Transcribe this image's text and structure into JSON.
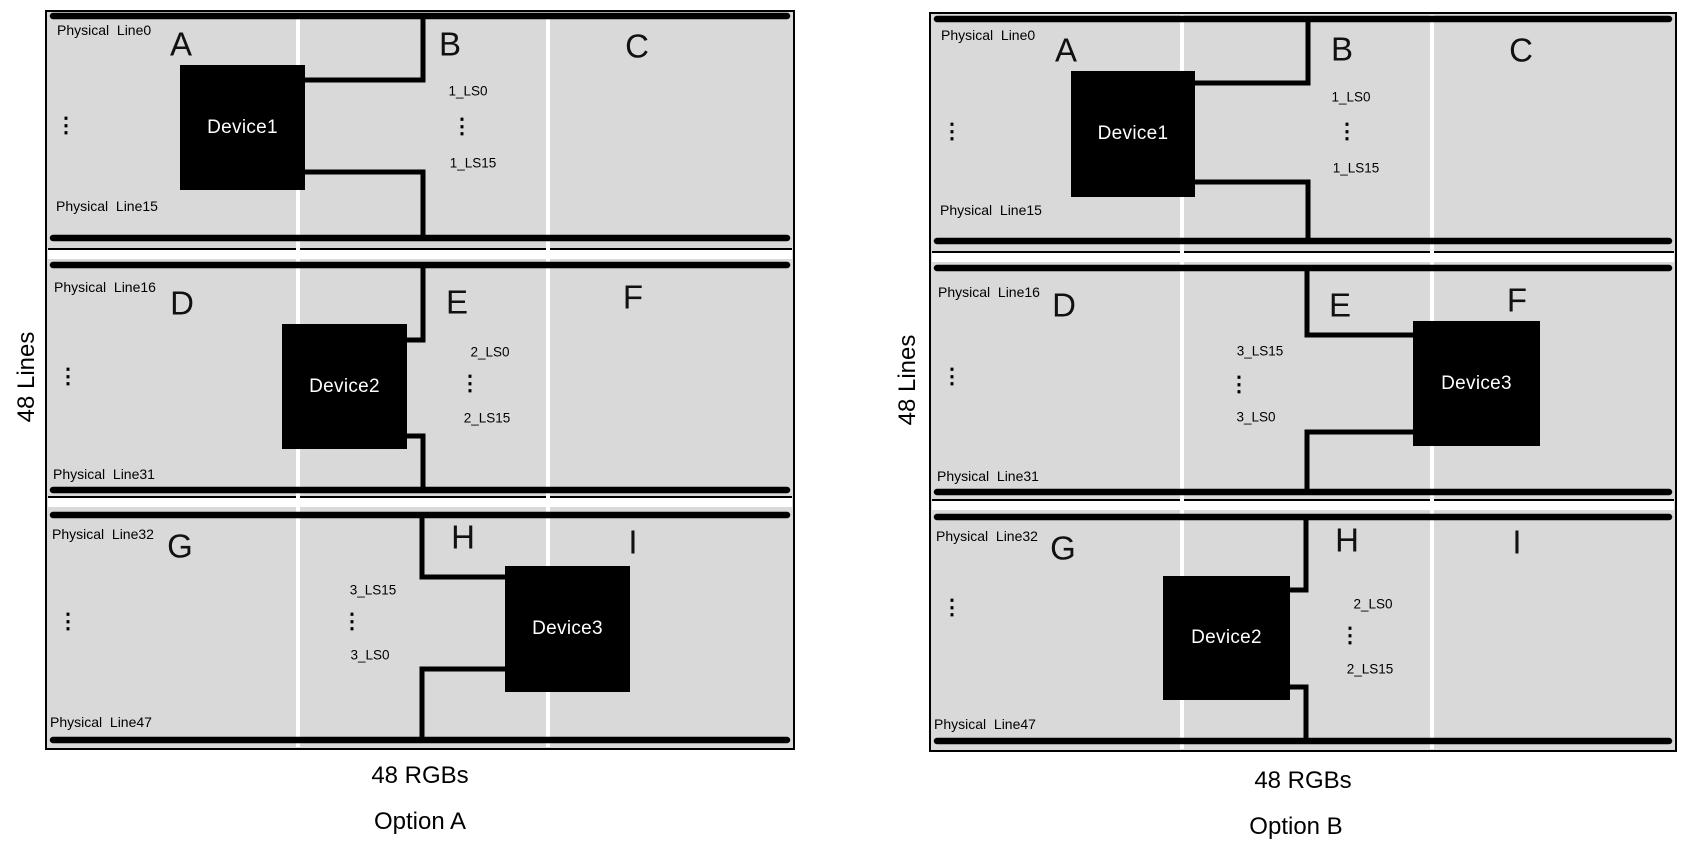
{
  "colors": {
    "background": "#ffffff",
    "panel_fill": "#d9d9d9",
    "bus_line": "#000000",
    "wire": "#000000",
    "device_fill": "#000000",
    "device_text": "#ffffff",
    "cell_divider": "#ffffff"
  },
  "options": [
    {
      "id": "a",
      "caption": "Option A",
      "lines_axis_label": "48 Lines",
      "rgbs_axis_label": "48 RGBs",
      "panel": {
        "x": 45,
        "y": 10,
        "w": 750,
        "h": 740
      },
      "dividers_x": [
        296,
        546
      ],
      "band_gaps": [
        {
          "line_y": 248,
          "strip_y": 250,
          "strip_h": 9
        },
        {
          "line_y": 496,
          "strip_y": 498,
          "strip_h": 9
        }
      ],
      "bus_lines": [
        {
          "name": "physical-line0-bus",
          "y": 16,
          "label": "Physical  Line0",
          "label_x": 57,
          "label_y": 22
        },
        {
          "name": "physical-line15-bus",
          "y": 238,
          "label": "Physical  Line15",
          "label_x": 56,
          "label_y": 198
        },
        {
          "name": "physical-line16-bus",
          "y": 265,
          "label": "Physical  Line16",
          "label_x": 54,
          "label_y": 279
        },
        {
          "name": "physical-line31-bus",
          "y": 490,
          "label": "Physical  Line31",
          "label_x": 53,
          "label_y": 466
        },
        {
          "name": "physical-line32-bus",
          "y": 515,
          "label": "Physical  Line32",
          "label_x": 52,
          "label_y": 526
        },
        {
          "name": "physical-line47-bus",
          "y": 740,
          "label": "Physical  Line47",
          "label_x": 50,
          "label_y": 714
        }
      ],
      "region_letters": [
        {
          "t": "A",
          "x": 181,
          "y": 44
        },
        {
          "t": "B",
          "x": 450,
          "y": 44
        },
        {
          "t": "C",
          "x": 637,
          "y": 46
        },
        {
          "t": "D",
          "x": 182,
          "y": 303
        },
        {
          "t": "E",
          "x": 457,
          "y": 302
        },
        {
          "t": "F",
          "x": 633,
          "y": 297
        },
        {
          "t": "G",
          "x": 180,
          "y": 546
        },
        {
          "t": "H",
          "x": 463,
          "y": 537
        },
        {
          "t": "I",
          "x": 633,
          "y": 542
        }
      ],
      "devices": [
        {
          "label": "Device1",
          "x": 180,
          "y": 65,
          "w": 125,
          "h": 125
        },
        {
          "label": "Device2",
          "x": 282,
          "y": 324,
          "w": 125,
          "h": 125
        },
        {
          "label": "Device3",
          "x": 505,
          "y": 566,
          "w": 125,
          "h": 126
        }
      ],
      "ls_labels": [
        {
          "t": "1_LS0",
          "x": 468,
          "y": 91
        },
        {
          "t": "1_LS15",
          "x": 473,
          "y": 163
        },
        {
          "t": "2_LS0",
          "x": 490,
          "y": 352
        },
        {
          "t": "2_LS15",
          "x": 487,
          "y": 418
        },
        {
          "t": "3_LS15",
          "x": 373,
          "y": 590
        },
        {
          "t": "3_LS0",
          "x": 370,
          "y": 655
        }
      ],
      "ellipses": [
        {
          "x": 66,
          "y": 126
        },
        {
          "x": 462,
          "y": 127
        },
        {
          "x": 68,
          "y": 377
        },
        {
          "x": 470,
          "y": 384
        },
        {
          "x": 68,
          "y": 622
        },
        {
          "x": 352,
          "y": 622
        }
      ],
      "wires": [
        {
          "name": "device1-top-wire",
          "points": "303,80 423,80 423,16"
        },
        {
          "name": "device1-bottom-wire",
          "points": "303,172 423,172 423,238"
        },
        {
          "name": "device2-top-wire",
          "points": "406,340 423,340 423,265"
        },
        {
          "name": "device2-bottom-wire",
          "points": "406,436 423,436 423,490"
        },
        {
          "name": "device3-top-wire",
          "points": "506,577 422,577 422,515"
        },
        {
          "name": "device3-bottom-wire",
          "points": "506,669 422,669 422,740"
        }
      ]
    },
    {
      "id": "b",
      "caption": "Option B",
      "lines_axis_label": "48 Lines",
      "rgbs_axis_label": "48 RGBs",
      "panel": {
        "x": 929,
        "y": 12,
        "w": 748,
        "h": 740
      },
      "dividers_x": [
        1180,
        1430
      ],
      "band_gaps": [
        {
          "line_y": 251,
          "strip_y": 253,
          "strip_h": 9
        },
        {
          "line_y": 499,
          "strip_y": 501,
          "strip_h": 9
        }
      ],
      "bus_lines": [
        {
          "name": "physical-line0-bus",
          "y": 19,
          "label": "Physical  Line0",
          "label_x": 941,
          "label_y": 27
        },
        {
          "name": "physical-line15-bus",
          "y": 241,
          "label": "Physical  Line15",
          "label_x": 940,
          "label_y": 202
        },
        {
          "name": "physical-line16-bus",
          "y": 268,
          "label": "Physical  Line16",
          "label_x": 938,
          "label_y": 284
        },
        {
          "name": "physical-line31-bus",
          "y": 492,
          "label": "Physical  Line31",
          "label_x": 937,
          "label_y": 468
        },
        {
          "name": "physical-line32-bus",
          "y": 517,
          "label": "Physical  Line32",
          "label_x": 936,
          "label_y": 528
        },
        {
          "name": "physical-line47-bus",
          "y": 741,
          "label": "Physical  Line47",
          "label_x": 934,
          "label_y": 716
        }
      ],
      "region_letters": [
        {
          "t": "A",
          "x": 1066,
          "y": 50
        },
        {
          "t": "B",
          "x": 1342,
          "y": 49
        },
        {
          "t": "C",
          "x": 1521,
          "y": 50
        },
        {
          "t": "D",
          "x": 1064,
          "y": 305
        },
        {
          "t": "E",
          "x": 1340,
          "y": 305
        },
        {
          "t": "F",
          "x": 1517,
          "y": 300
        },
        {
          "t": "G",
          "x": 1063,
          "y": 548
        },
        {
          "t": "H",
          "x": 1347,
          "y": 540
        },
        {
          "t": "I",
          "x": 1517,
          "y": 542
        }
      ],
      "devices": [
        {
          "label": "Device1",
          "x": 1071,
          "y": 71,
          "w": 124,
          "h": 126
        },
        {
          "label": "Device3",
          "x": 1413,
          "y": 321,
          "w": 127,
          "h": 125
        },
        {
          "label": "Device2",
          "x": 1163,
          "y": 576,
          "w": 127,
          "h": 124
        }
      ],
      "ls_labels": [
        {
          "t": "1_LS0",
          "x": 1351,
          "y": 97
        },
        {
          "t": "1_LS15",
          "x": 1356,
          "y": 168
        },
        {
          "t": "3_LS15",
          "x": 1260,
          "y": 351
        },
        {
          "t": "3_LS0",
          "x": 1256,
          "y": 417
        },
        {
          "t": "2_LS0",
          "x": 1373,
          "y": 604
        },
        {
          "t": "2_LS15",
          "x": 1370,
          "y": 669
        }
      ],
      "ellipses": [
        {
          "x": 952,
          "y": 132
        },
        {
          "x": 1347,
          "y": 132
        },
        {
          "x": 952,
          "y": 377
        },
        {
          "x": 1239,
          "y": 385
        },
        {
          "x": 952,
          "y": 608
        },
        {
          "x": 1350,
          "y": 636
        }
      ],
      "wires": [
        {
          "name": "device1-top-wire",
          "points": "1194,83 1308,83 1308,19"
        },
        {
          "name": "device1-bottom-wire",
          "points": "1194,182 1308,182 1308,241"
        },
        {
          "name": "device3-top-wire",
          "points": "1414,335 1307,335 1307,268"
        },
        {
          "name": "device3-bottom-wire",
          "points": "1414,432 1307,432 1307,492"
        },
        {
          "name": "device2-top-wire",
          "points": "1289,590 1306,590 1306,517"
        },
        {
          "name": "device2-bottom-wire",
          "points": "1289,687 1306,687 1306,741"
        }
      ]
    }
  ],
  "axis": {
    "lines_a_pos": {
      "x": 27,
      "y": 377
    },
    "rgbs_a_pos": {
      "x": 420,
      "y": 776
    },
    "caption_a_pos": {
      "x": 420,
      "y": 822
    },
    "lines_b_pos": {
      "x": 908,
      "y": 380
    },
    "rgbs_b_pos": {
      "x": 1303,
      "y": 781
    },
    "caption_b_pos": {
      "x": 1296,
      "y": 827
    }
  }
}
